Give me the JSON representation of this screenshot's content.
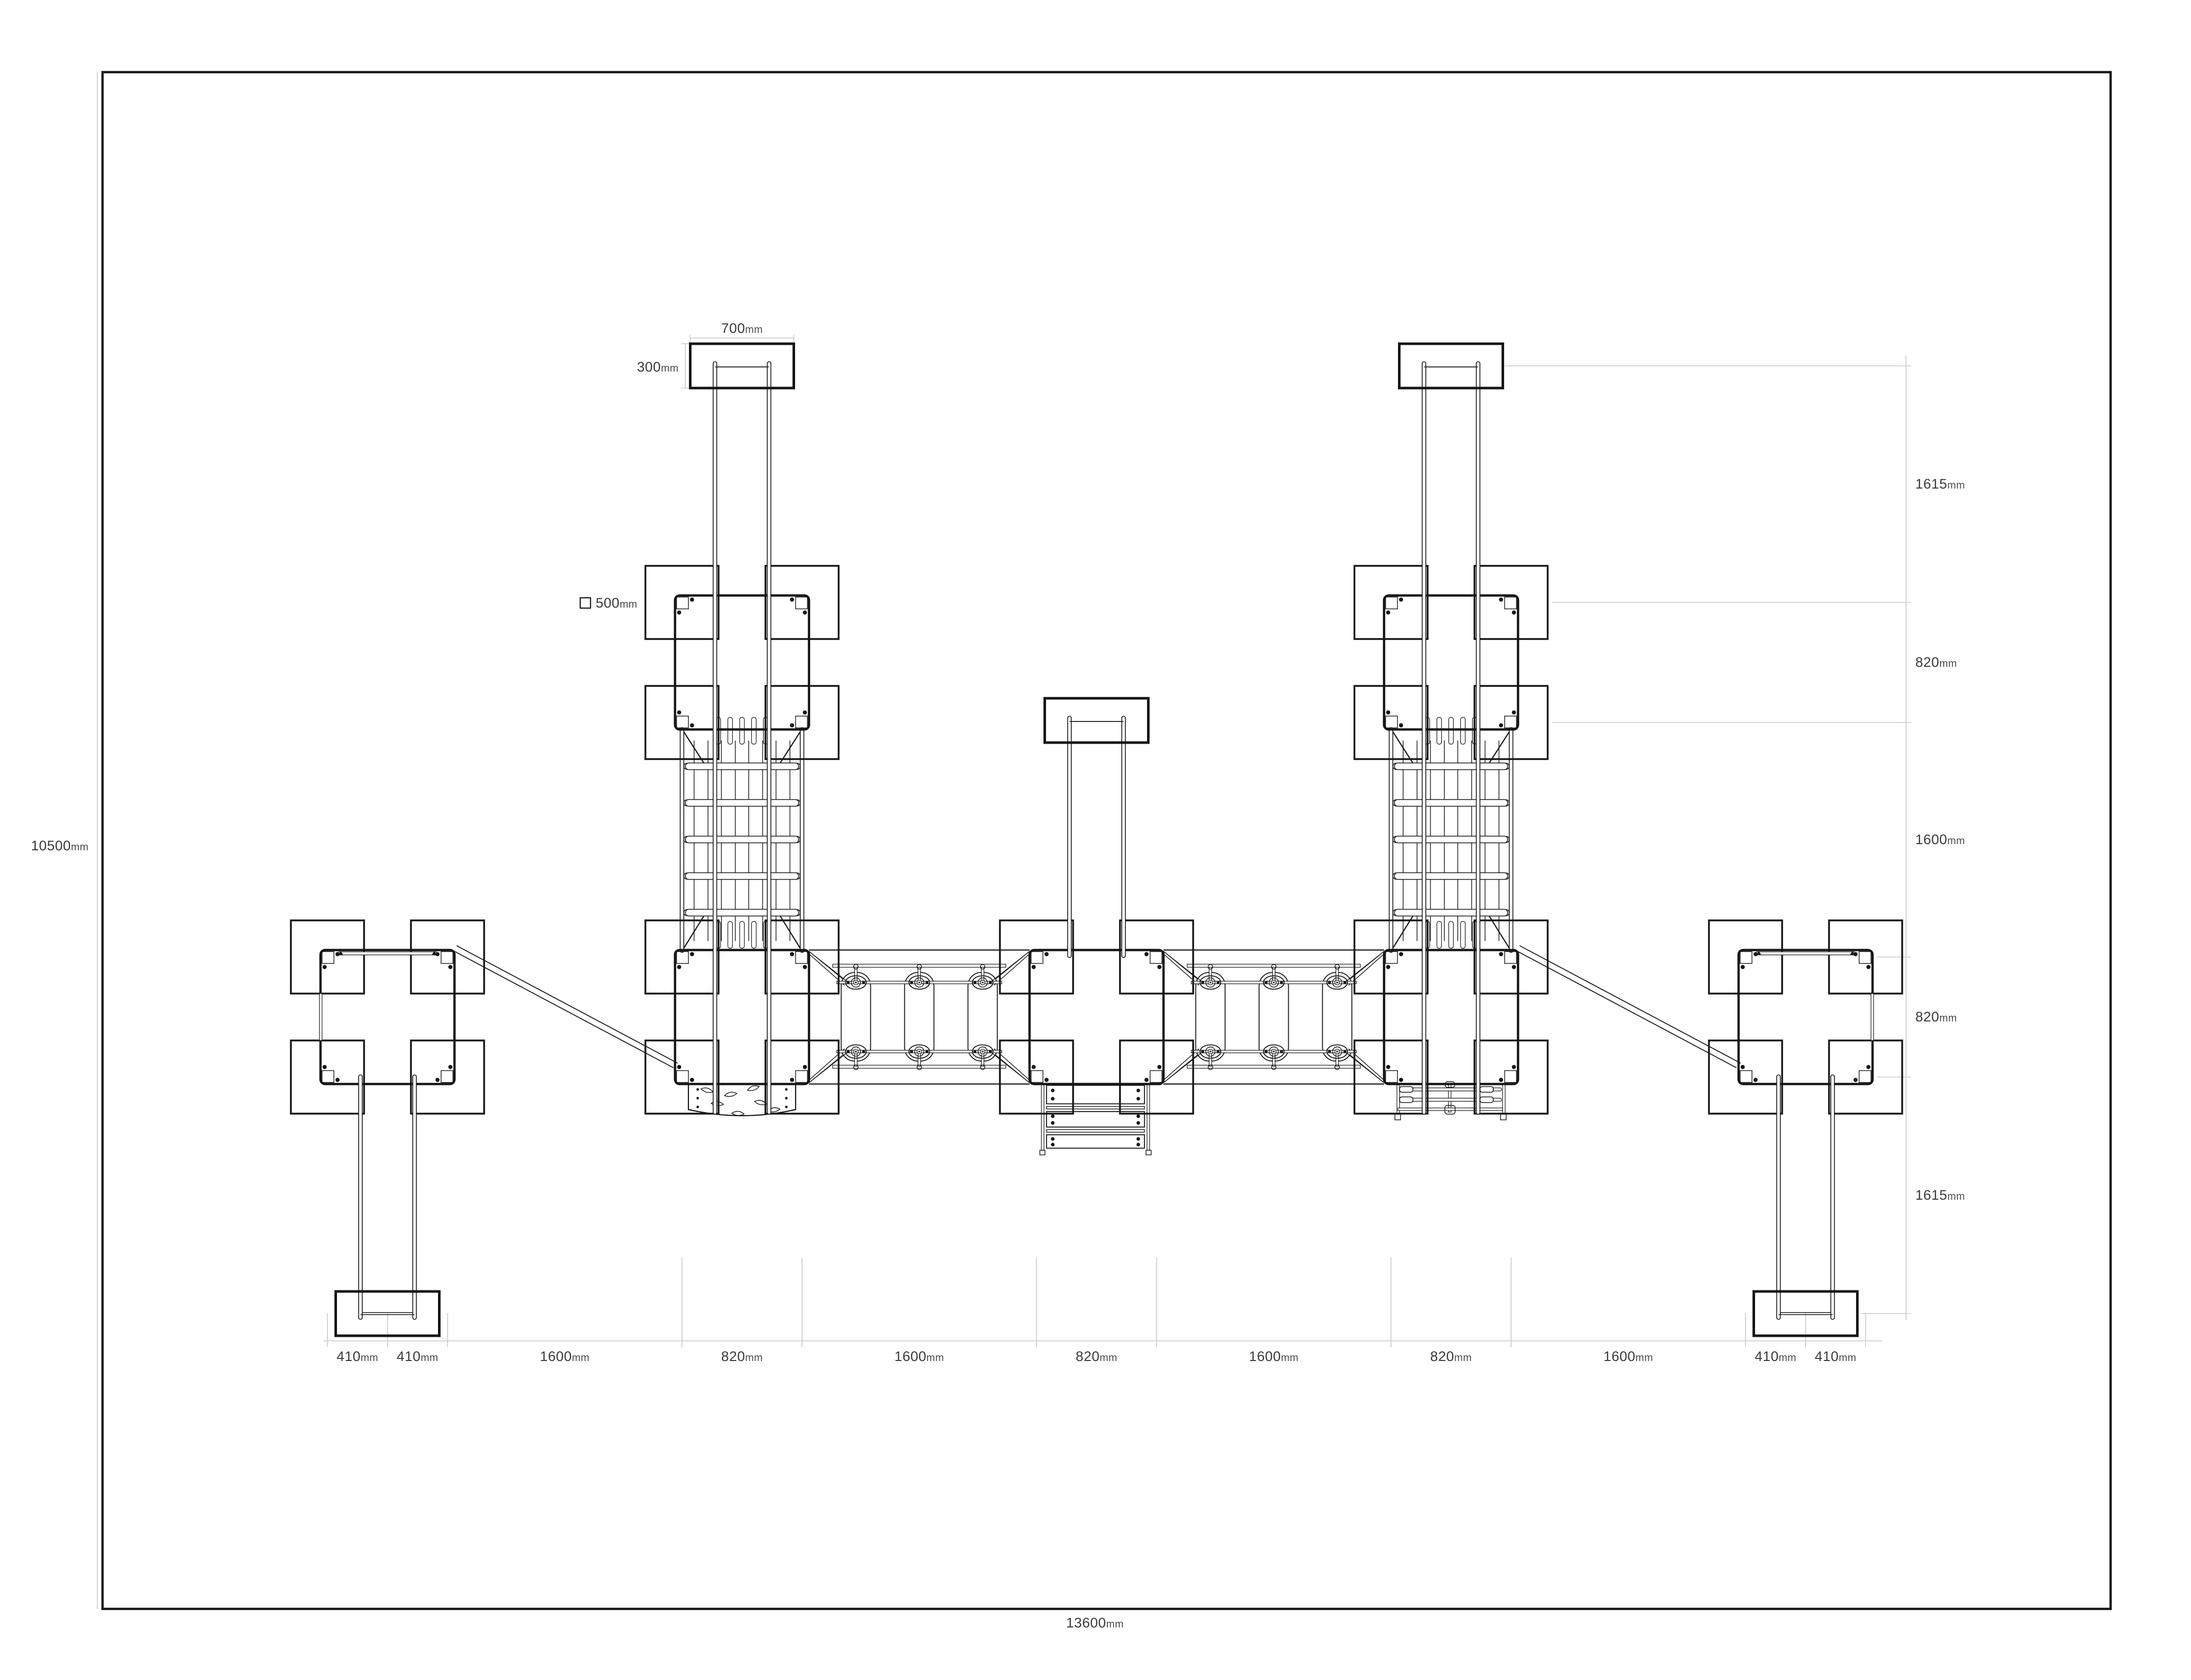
{
  "drawing": {
    "type": "playground-equipment-plan",
    "colors": {
      "line": "#161616",
      "dim_line": "#c5c8ca",
      "text": "#3a3a3a",
      "background": "#ffffff"
    },
    "legend": {
      "post_symbol": "square-icon",
      "post_size": {
        "value": "500",
        "unit": "mm"
      }
    },
    "dims": {
      "height_overall": {
        "value": "10500",
        "unit": "mm"
      },
      "width_overall": {
        "value": "13600",
        "unit": "mm"
      },
      "top_box_width": {
        "value": "700",
        "unit": "mm"
      },
      "top_box_depth": {
        "value": "300",
        "unit": "mm"
      },
      "bottom": [
        {
          "value": "410",
          "unit": "mm"
        },
        {
          "value": "410",
          "unit": "mm"
        },
        {
          "value": "1600",
          "unit": "mm"
        },
        {
          "value": "820",
          "unit": "mm"
        },
        {
          "value": "1600",
          "unit": "mm"
        },
        {
          "value": "820",
          "unit": "mm"
        },
        {
          "value": "1600",
          "unit": "mm"
        },
        {
          "value": "820",
          "unit": "mm"
        },
        {
          "value": "1600",
          "unit": "mm"
        },
        {
          "value": "410",
          "unit": "mm"
        },
        {
          "value": "410",
          "unit": "mm"
        }
      ],
      "right": [
        {
          "value": "1615",
          "unit": "mm"
        },
        {
          "value": "820",
          "unit": "mm"
        },
        {
          "value": "1600",
          "unit": "mm"
        },
        {
          "value": "820",
          "unit": "mm"
        },
        {
          "value": "1615",
          "unit": "mm"
        }
      ]
    }
  }
}
